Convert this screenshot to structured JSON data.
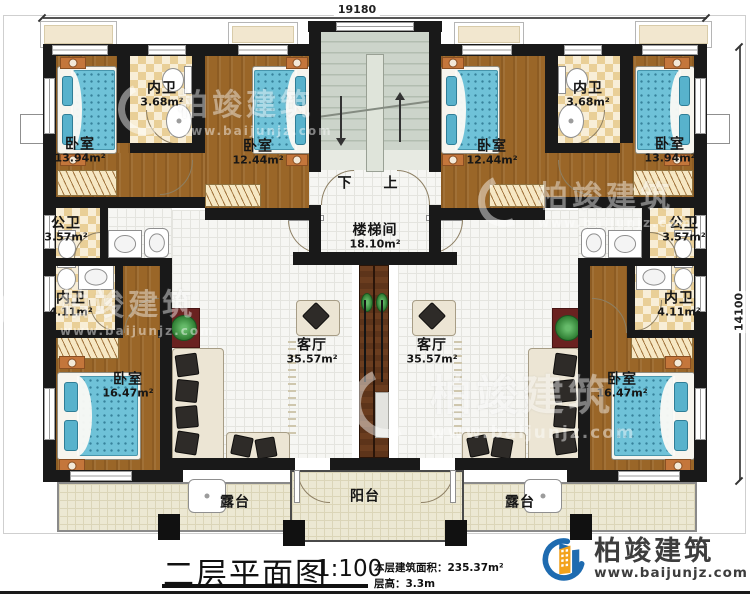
{
  "dimensions": {
    "top": "19180",
    "right": "14100"
  },
  "stairs": {
    "down": "下",
    "up": "上"
  },
  "rooms": [
    {
      "id": "bedroom-top-left",
      "label": "卧室",
      "area": "13.94m²"
    },
    {
      "id": "ensuite-top-left",
      "label": "内卫",
      "area": "3.68m²"
    },
    {
      "id": "bedroom-top-left-2",
      "label": "卧室",
      "area": "12.44m²"
    },
    {
      "id": "stair-hall",
      "label": "楼梯间",
      "area": "18.10m²"
    },
    {
      "id": "bedroom-top-right-2",
      "label": "卧室",
      "area": "12.44m²"
    },
    {
      "id": "ensuite-top-right",
      "label": "内卫",
      "area": "3.68m²"
    },
    {
      "id": "bedroom-top-right",
      "label": "卧室",
      "area": "13.94m²"
    },
    {
      "id": "shared-bath-left",
      "label": "公卫",
      "area": "3.57m²"
    },
    {
      "id": "shared-bath-right",
      "label": "公卫",
      "area": "3.57m²"
    },
    {
      "id": "ensuite-mid-left",
      "label": "内卫",
      "area": "4.11m²"
    },
    {
      "id": "ensuite-mid-right",
      "label": "内卫",
      "area": "4.11m²"
    },
    {
      "id": "living-room-left",
      "label": "客厅",
      "area": "35.57m²"
    },
    {
      "id": "living-room-right",
      "label": "客厅",
      "area": "35.57m²"
    },
    {
      "id": "bedroom-bottom-left",
      "label": "卧室",
      "area": "16.47m²"
    },
    {
      "id": "bedroom-bottom-right",
      "label": "卧室",
      "area": "16.47m²"
    },
    {
      "id": "terrace-left",
      "label": "露台",
      "area": ""
    },
    {
      "id": "balcony",
      "label": "阳台",
      "area": ""
    },
    {
      "id": "terrace-right",
      "label": "露台",
      "area": ""
    }
  ],
  "title_block": {
    "title": "二层平面图",
    "scale": "1:100",
    "info_line1": "本层建筑面积：235.37m²",
    "info_line2": "层高：3.3m"
  },
  "logo": {
    "name": "柏竣建筑",
    "url": "www.baijunjz.com"
  },
  "watermark": {
    "name": "柏竣建筑",
    "url": "www.baijunjz.com"
  },
  "colors": {
    "wall": "#191919",
    "wood_floor": "#9a6628",
    "bed": "#6fc2d8",
    "checker": "#e9cf97",
    "logo_blue": "#1e6bb0",
    "logo_orange": "#f2a21c"
  }
}
